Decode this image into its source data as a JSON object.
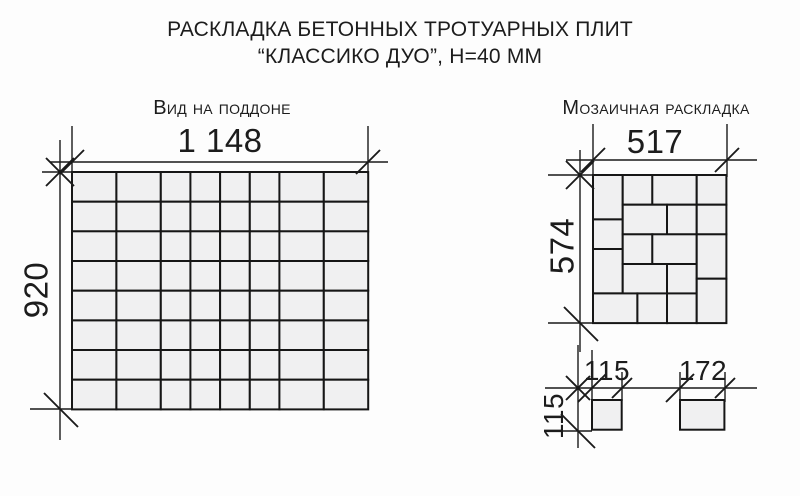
{
  "title": {
    "line1": "РАСКЛАДКА БЕТОННЫХ ТРОТУАРНЫХ ПЛИТ",
    "line2": "“КЛАССИКО ДУО”, Н=40 ММ"
  },
  "pallet": {
    "heading": "Вид на поддоне",
    "width_label": "1 148",
    "height_label": "920",
    "columns_mm": [
      172,
      172,
      115,
      115,
      115,
      115,
      172,
      172
    ],
    "rows_mm": [
      115,
      115,
      115,
      115,
      115,
      115,
      115,
      115
    ]
  },
  "mosaic": {
    "heading": "Мозаичная раскладка",
    "width_label": "517",
    "height_label": "574",
    "tiles_mm": [
      [
        0,
        0,
        115,
        172
      ],
      [
        0,
        172,
        115,
        115
      ],
      [
        0,
        287,
        115,
        172
      ],
      [
        115,
        0,
        115,
        115
      ],
      [
        230,
        0,
        172,
        115
      ],
      [
        115,
        115,
        172,
        115
      ],
      [
        287,
        115,
        115,
        115
      ],
      [
        115,
        230,
        115,
        115
      ],
      [
        230,
        230,
        172,
        115
      ],
      [
        115,
        345,
        172,
        115
      ],
      [
        287,
        345,
        115,
        115
      ],
      [
        0,
        459,
        172,
        115
      ],
      [
        172,
        459,
        115,
        115
      ],
      [
        287,
        459,
        115,
        115
      ],
      [
        402,
        0,
        115,
        115
      ],
      [
        402,
        115,
        115,
        115
      ],
      [
        402,
        230,
        115,
        172
      ],
      [
        402,
        402,
        115,
        172
      ]
    ]
  },
  "plates": {
    "small": {
      "width_label": "115",
      "height_label": "115",
      "w_mm": 115,
      "h_mm": 115
    },
    "large": {
      "width_label": "172",
      "w_mm": 172,
      "h_mm": 115
    }
  },
  "colors": {
    "line": "#1a1a1a",
    "tile_fill": "#f0f0f1",
    "background": "#ffffff"
  }
}
